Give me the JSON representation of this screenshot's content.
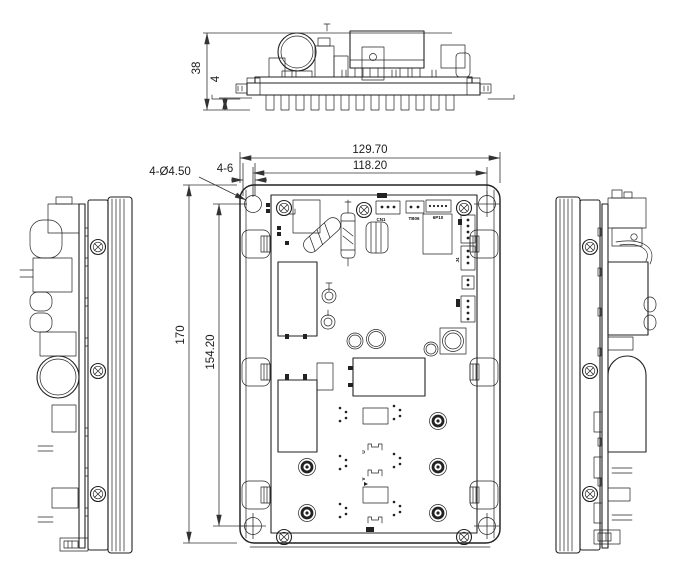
{
  "drawing": {
    "dimensions": {
      "overall_width": "129.70",
      "hole_span_width": "118.20",
      "overall_height": "170",
      "hole_span_height": "154.20",
      "profile_height": "38",
      "standoff_height": "4",
      "hole_callout": "4-Ø4.50",
      "slot_callout": "4-6"
    },
    "component_labels": {
      "cn1": "CN1",
      "tb06": "TB06",
      "p10": "6P10",
      "j4": "J4",
      "u": "U",
      "v": "V"
    },
    "colors": {
      "line": "#222222",
      "background": "#ffffff"
    }
  }
}
